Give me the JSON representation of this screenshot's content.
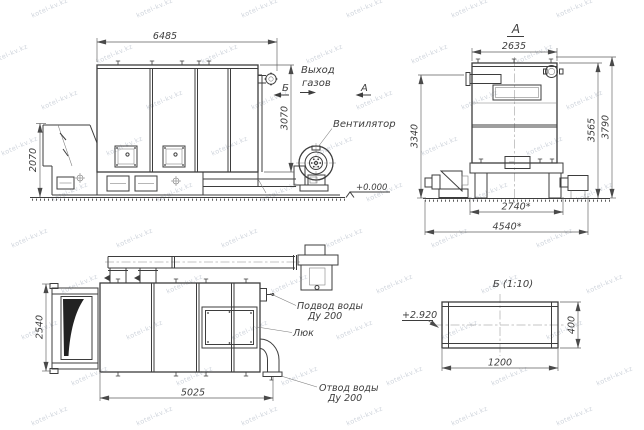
{
  "watermark": {
    "text": "kotel-kv.kz"
  },
  "side_view": {
    "dim_width": "6485",
    "dim_height": "3070",
    "dim_hopper_height": "2070",
    "label_gas_outlet_line1": "Выход",
    "label_gas_outlet_line2": "газов",
    "label_fan": "Вентилятор",
    "label_level": "+0.000",
    "section_b": "Б",
    "section_a": "А"
  },
  "front_view": {
    "title": "А",
    "dim_width": "2635",
    "dim_height_feeder": "3340",
    "dim_height_body": "3565",
    "dim_height_total": "3790",
    "dim_base_width": "2740*",
    "dim_overall_width": "4540*"
  },
  "plan_view": {
    "dim_depth": "2540",
    "dim_length": "5025",
    "label_water_supply_line1": "Подвод воды",
    "label_water_supply_line2": "Ду 200",
    "label_hatch": "Люк",
    "label_water_drain_line1": "Отвод воды",
    "label_water_drain_line2": "Ду 200"
  },
  "detail_view": {
    "title": "Б (1:10)",
    "level_mark": "+2.920",
    "dim_width": "1200",
    "dim_height": "400"
  }
}
